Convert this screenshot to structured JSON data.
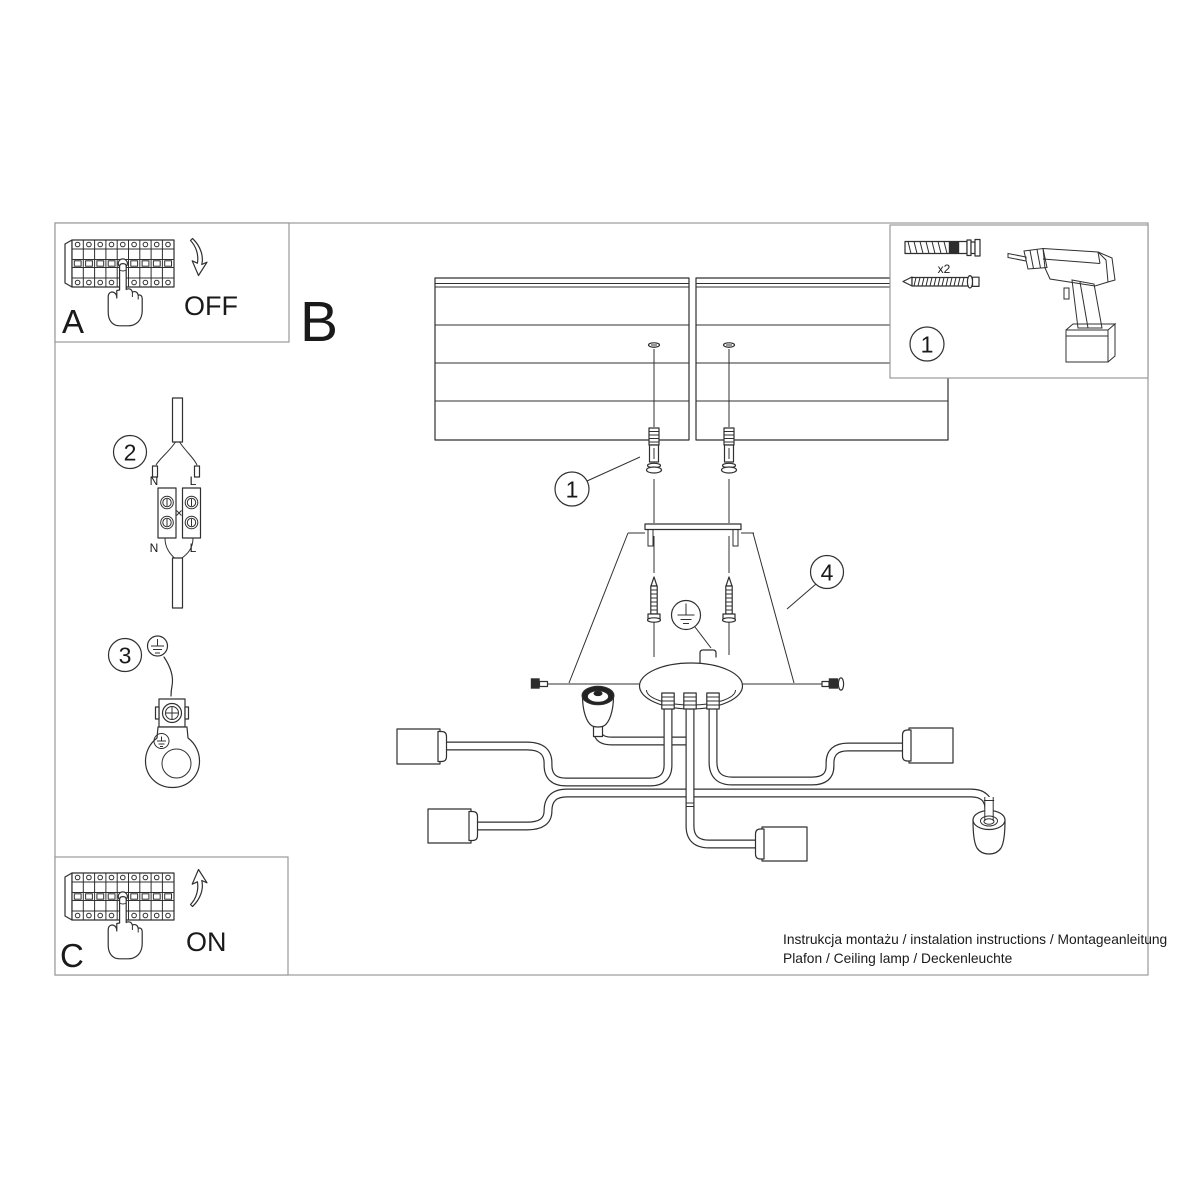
{
  "meta": {
    "background": "#ffffff",
    "line_color": "#303030",
    "frame_color": "#9a9a9a",
    "text_color": "#1a1a1a"
  },
  "sections": {
    "a": {
      "label": "A",
      "action": "OFF"
    },
    "b": {
      "label": "B"
    },
    "c": {
      "label": "C",
      "action": "ON"
    }
  },
  "callouts": {
    "c1": "1",
    "c2": "2",
    "c3": "3",
    "c4": "4"
  },
  "toolbox": {
    "step": "1",
    "screw_qty": "x2"
  },
  "wiring": {
    "top_n": "N",
    "top_l": "L",
    "bottom_n": "N",
    "bottom_l": "L"
  },
  "footer": {
    "line1": "Instrukcja montażu / instalation instructions / Montageanleitung",
    "line2": "Plafon / Ceiling lamp / Deckenleuchte"
  }
}
